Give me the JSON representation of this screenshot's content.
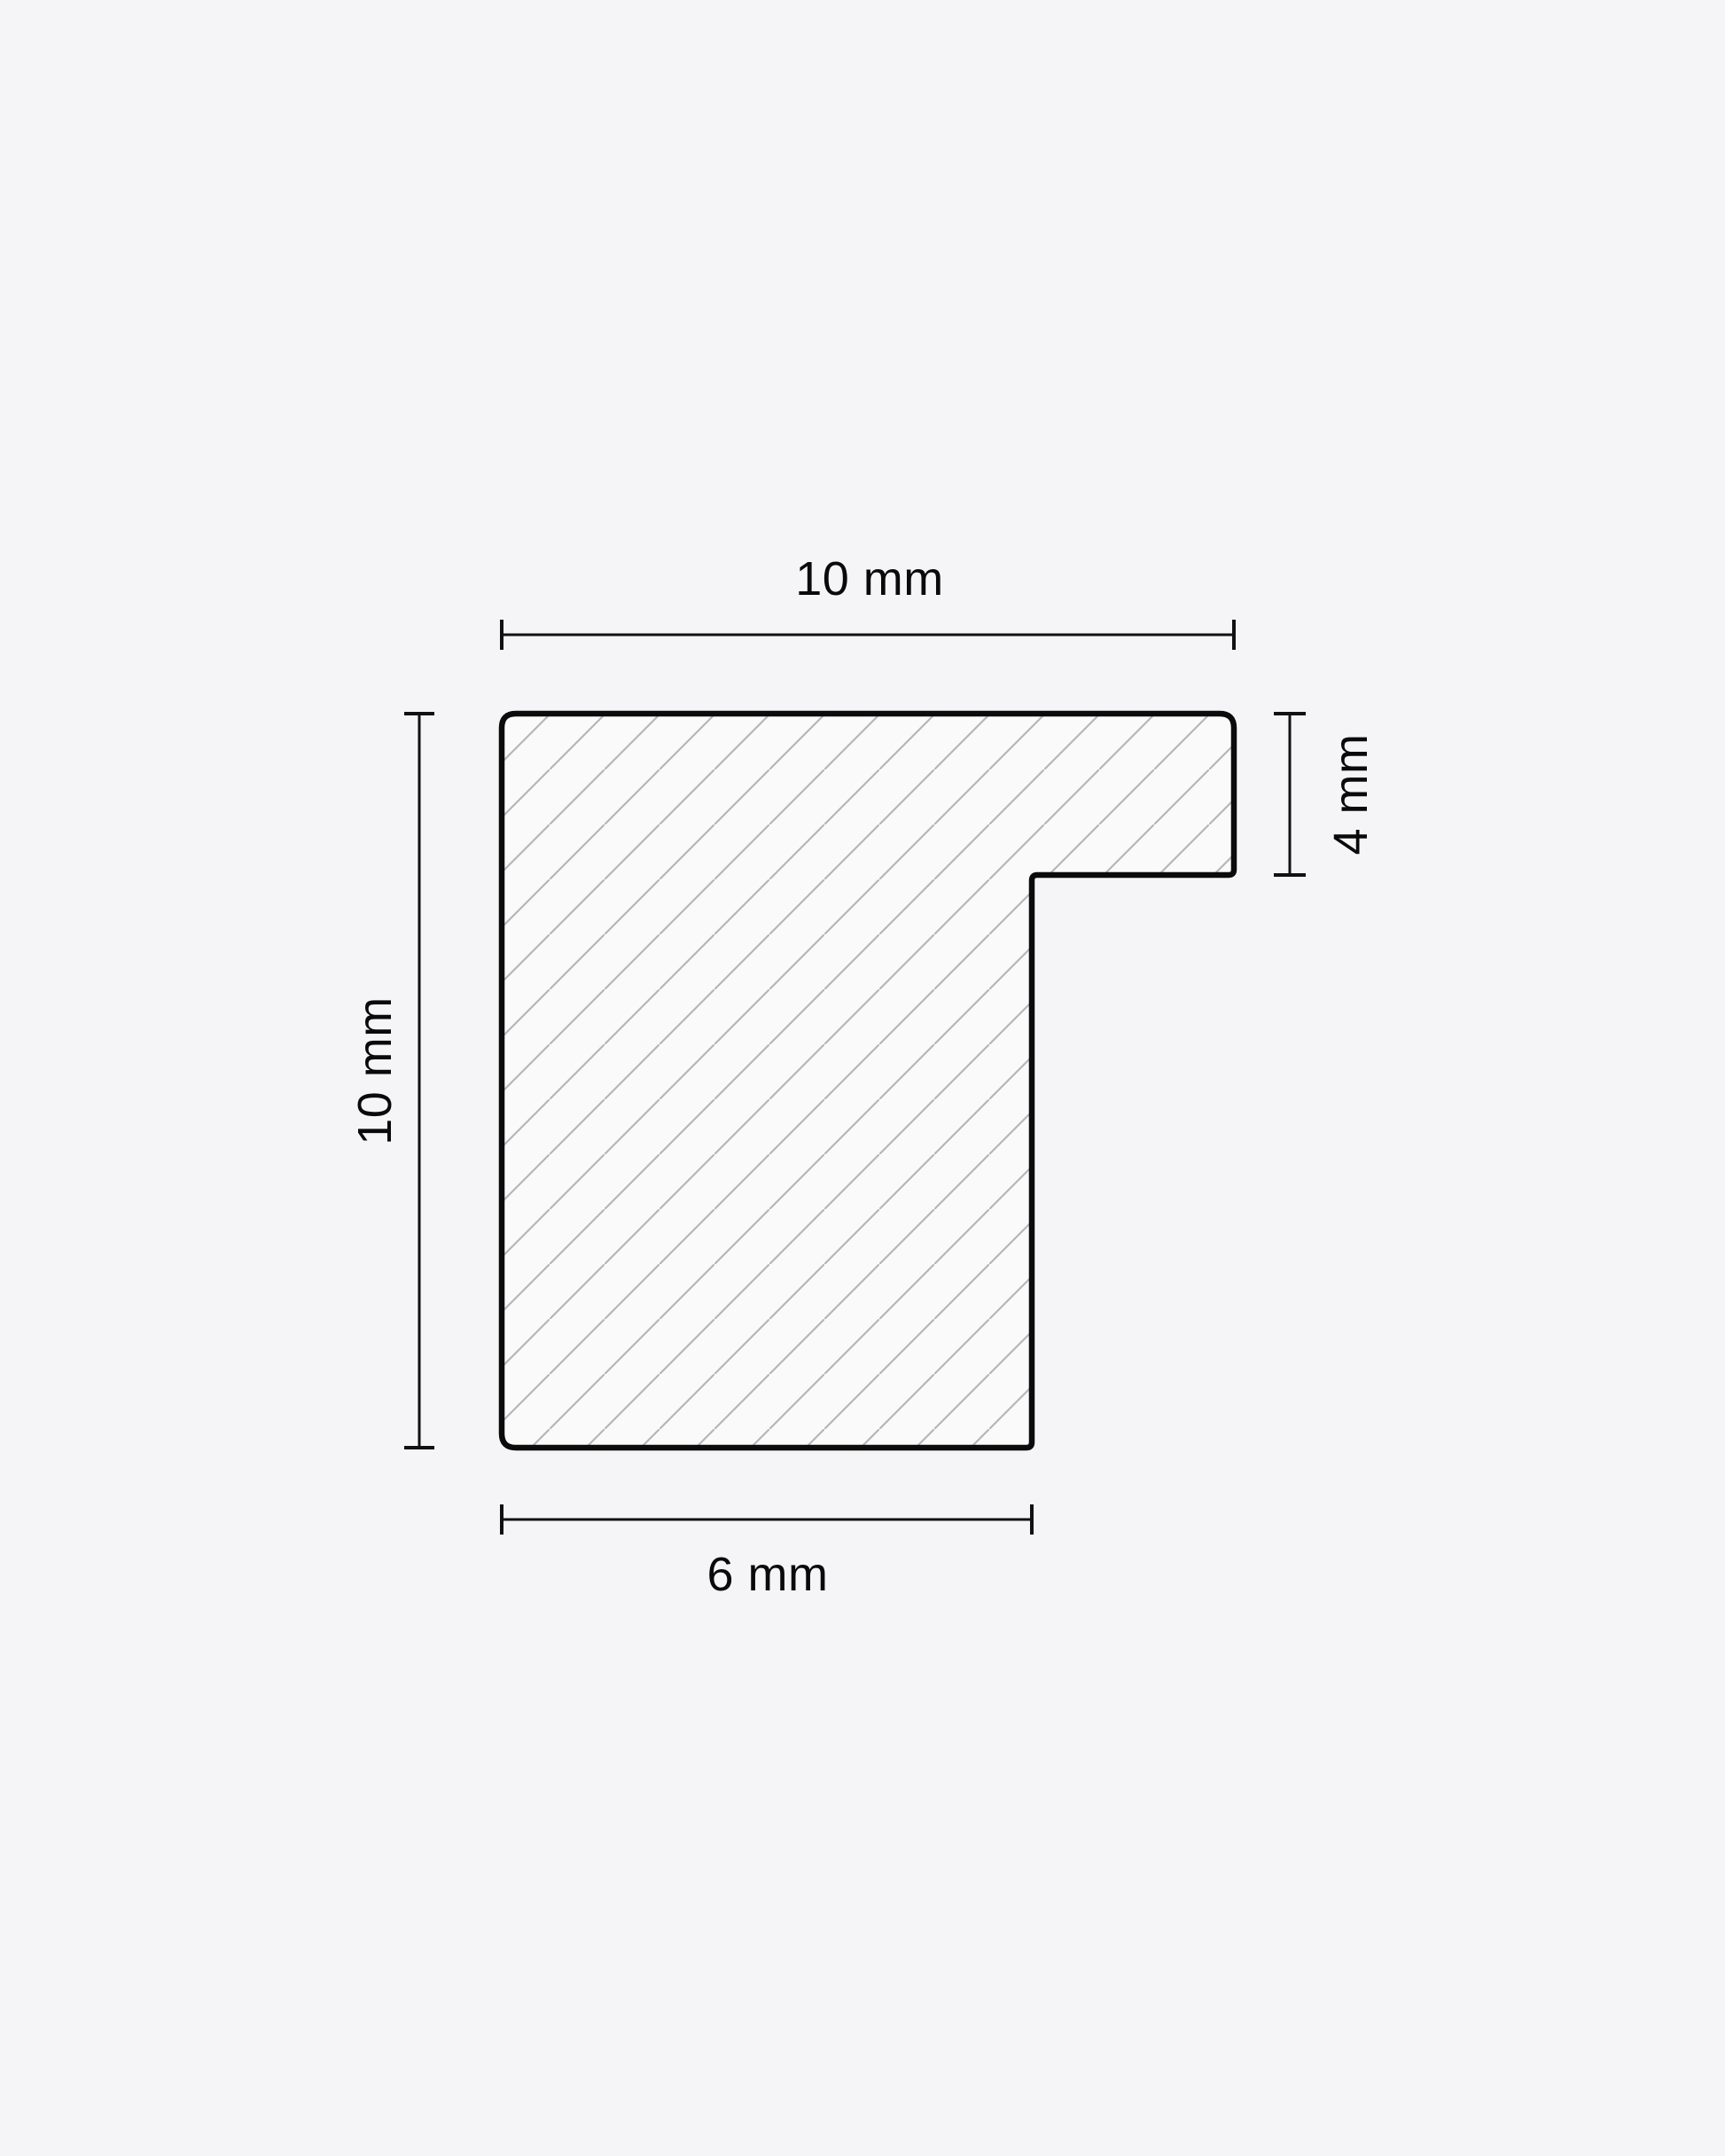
{
  "diagram": {
    "dimensions": {
      "top": {
        "label": "10 mm",
        "value": 10,
        "unit": "mm"
      },
      "left": {
        "label": "10 mm",
        "value": 10,
        "unit": "mm"
      },
      "right": {
        "label": "4 mm",
        "value": 4,
        "unit": "mm"
      },
      "bottom": {
        "label": "6 mm",
        "value": 6,
        "unit": "mm"
      }
    },
    "colors": {
      "background": "#f5f5f7",
      "outline": "#0b0b0c",
      "shape_fill": "#fafafb",
      "hatch_line": "#b6b6ba",
      "dimension_line": "#111113",
      "text": "#0a0a0a"
    }
  }
}
